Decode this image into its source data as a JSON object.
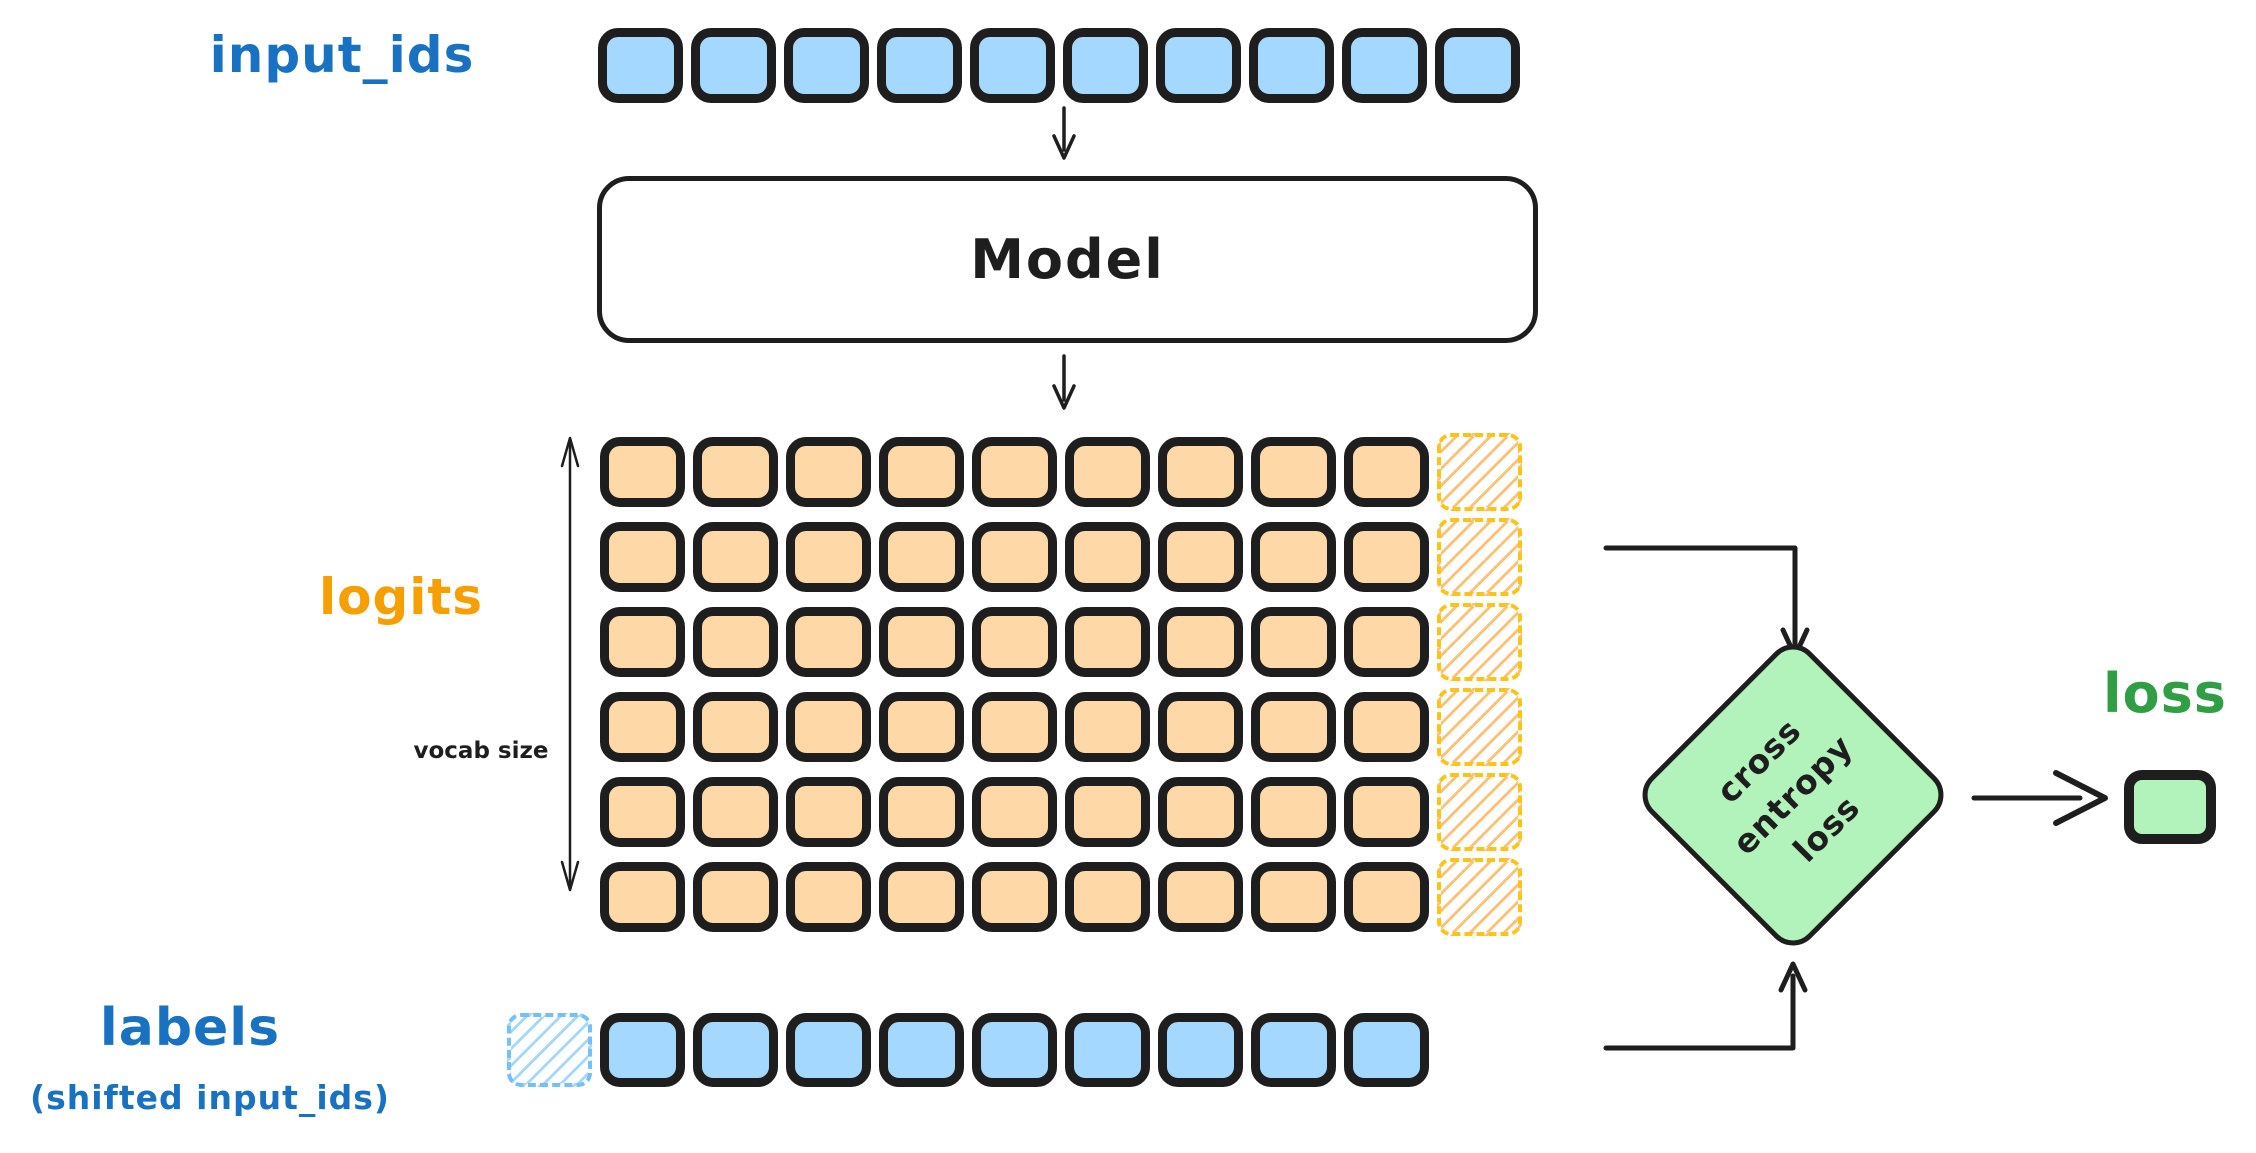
{
  "colors": {
    "blue_fill": "#a5d8ff",
    "blue_text": "#1971c2",
    "blue_dashed": "#74c0fc",
    "orange_fill": "#ffd8a8",
    "orange_text": "#f59f00",
    "yellow_dashed": "#fcc419",
    "orange_hatch": "#ffc078",
    "green_fill": "#b2f2bb",
    "green_text": "#2f9e44",
    "ink": "#1e1e1e"
  },
  "input_ids": {
    "label": "input_ids",
    "count": 10
  },
  "model": {
    "label": "Model"
  },
  "logits": {
    "label": "logits",
    "axis_label": "vocab size",
    "rows": 6,
    "cols": 9,
    "dashed_cols": 1
  },
  "labels_row": {
    "label": "labels",
    "sublabel": "(shifted input_ids)",
    "dashed_count": 1,
    "count": 9
  },
  "diamond": {
    "lines": [
      "cross",
      "entropy",
      "loss"
    ]
  },
  "loss": {
    "label": "loss"
  }
}
